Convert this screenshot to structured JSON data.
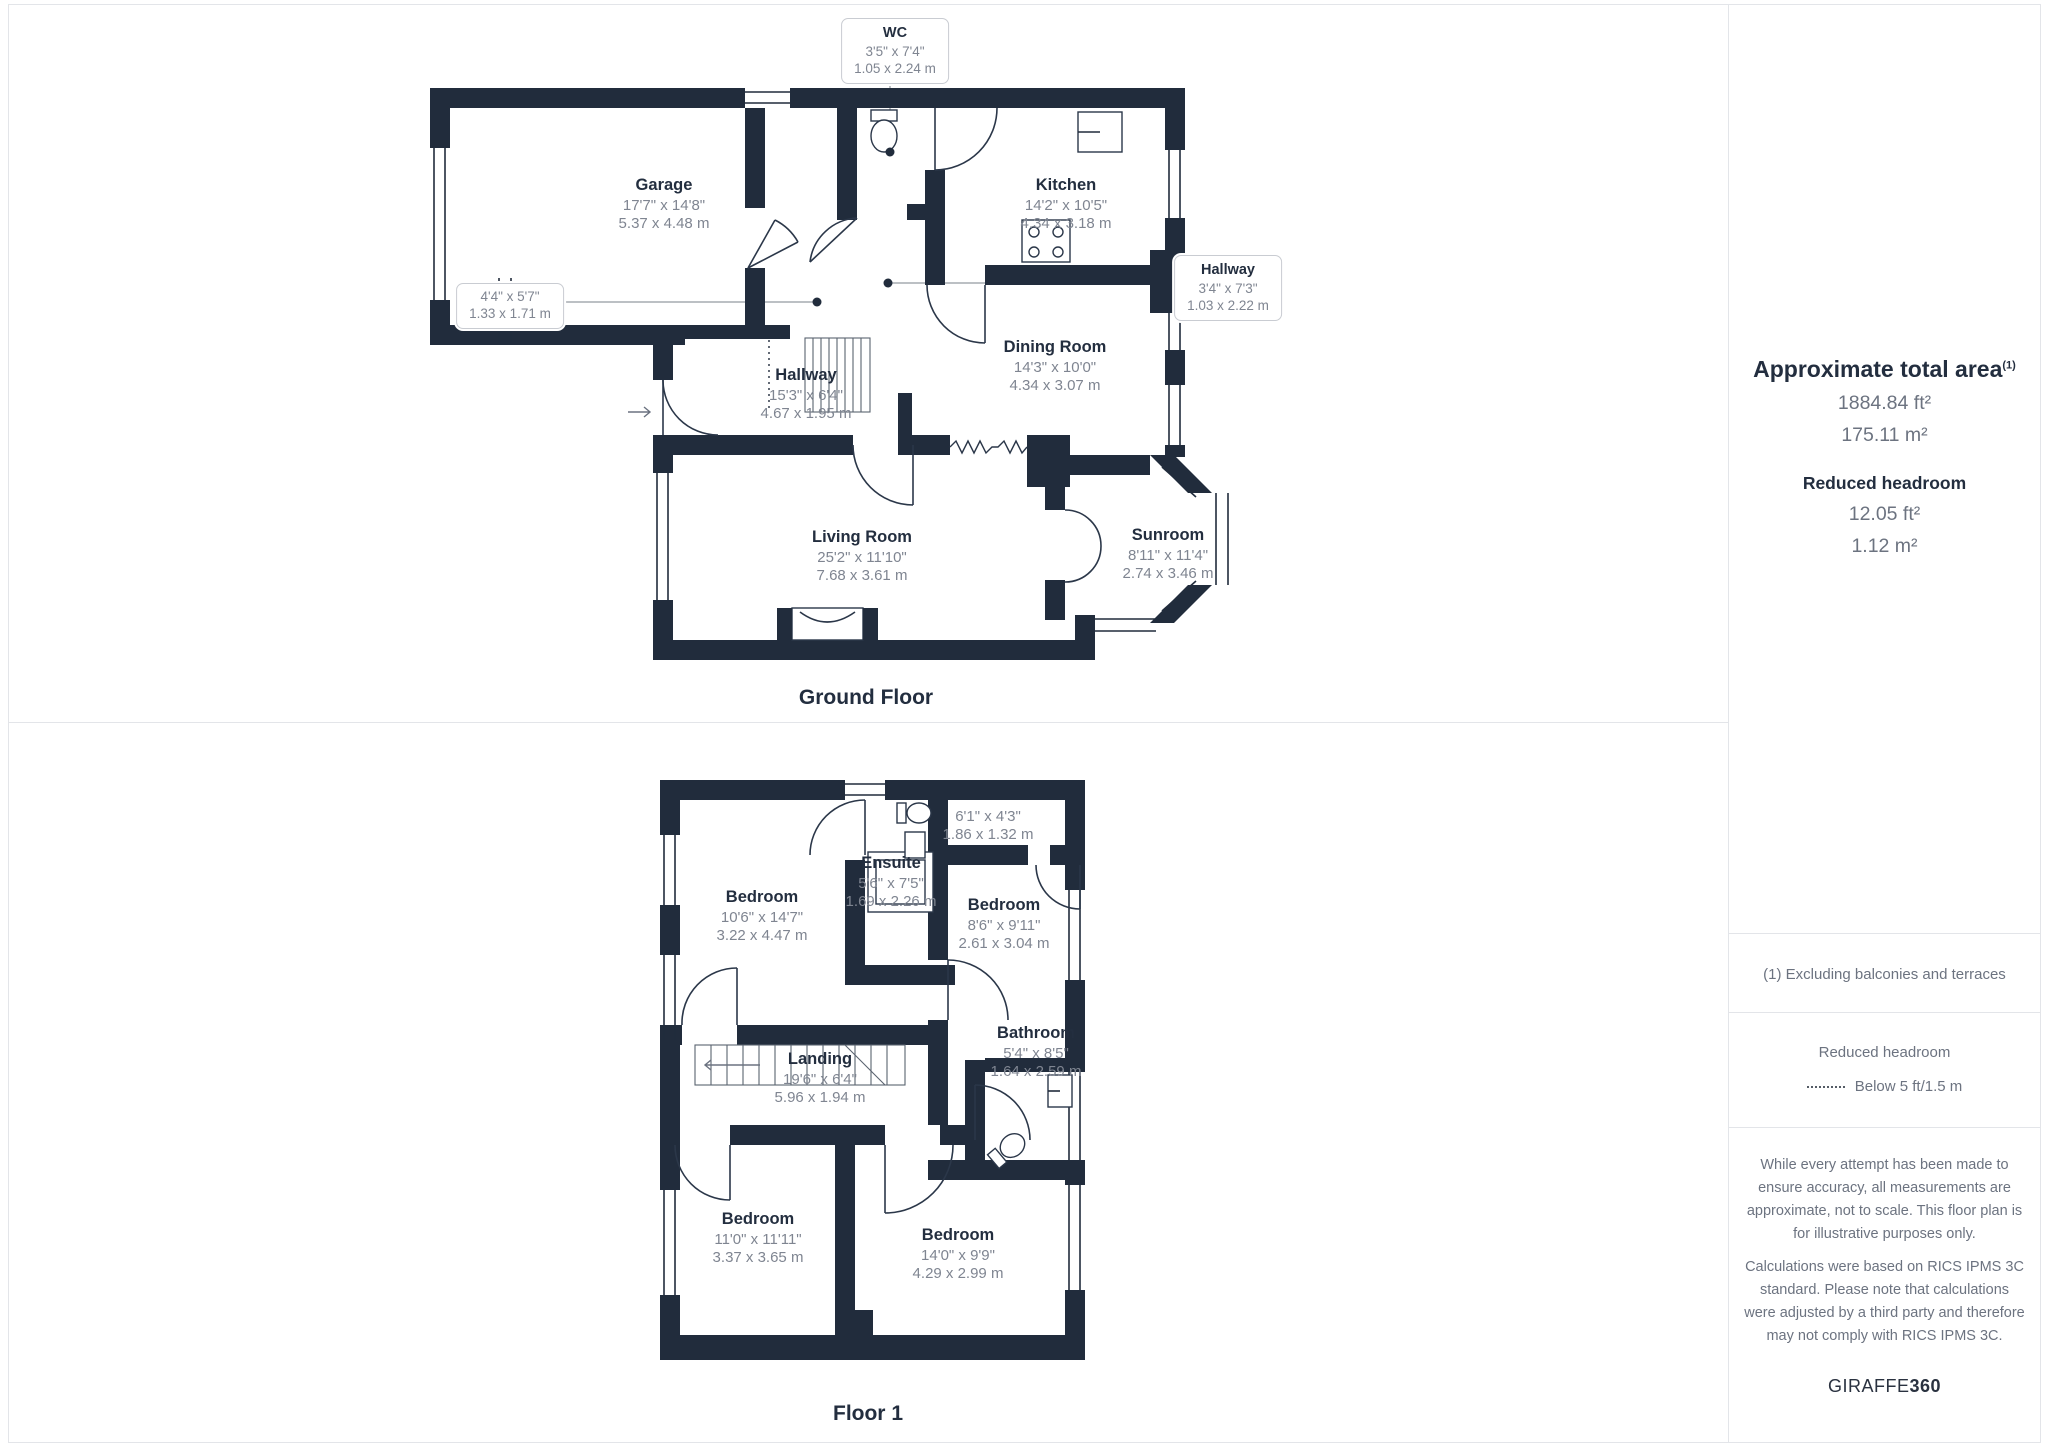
{
  "ground": {
    "title": "Ground Floor",
    "rooms": {
      "garage": {
        "name": "Garage",
        "imp": "17'7\" x 14'8\"",
        "met": "5.37 x 4.48 m"
      },
      "kitchen": {
        "name": "Kitchen",
        "imp": "14'2\" x 10'5\"",
        "met": "4.34 x 3.18 m"
      },
      "dining": {
        "name": "Dining Room",
        "imp": "14'3\" x 10'0\"",
        "met": "4.34 x 3.07 m"
      },
      "hallway": {
        "name": "Hallway",
        "imp": "15'3\" x 6'4\"",
        "met": "4.67 x 1.95 m"
      },
      "living": {
        "name": "Living Room",
        "imp": "25'2\" x 11'10\"",
        "met": "7.68 x 3.61 m"
      },
      "sunroom": {
        "name": "Sunroom",
        "imp": "8'11\" x 11'4\"",
        "met": "2.74 x 3.46 m"
      }
    },
    "callouts": {
      "wc": {
        "name": "WC",
        "imp": "3'5\" x 7'4\"",
        "met": "1.05 x 2.24 m"
      },
      "closet": {
        "imp": "4'4\" x 5'7\"",
        "met": "1.33 x 1.71 m"
      },
      "hallway2": {
        "name": "Hallway",
        "imp": "3'4\" x 7'3\"",
        "met": "1.03 x 2.22 m"
      }
    }
  },
  "floor1": {
    "title": "Floor 1",
    "rooms": {
      "bedroom_tl": {
        "name": "Bedroom",
        "imp": "10'6\" x 14'7\"",
        "met": "3.22 x 4.47 m"
      },
      "ensuite": {
        "name": "Ensuite",
        "imp": "5'6\" x 7'5\"",
        "met": "1.69 x 2.26 m"
      },
      "closet": {
        "imp": "6'1\" x 4'3\"",
        "met": "1.86 x 1.32 m"
      },
      "bedroom_r": {
        "name": "Bedroom",
        "imp": "8'6\" x 9'11\"",
        "met": "2.61 x 3.04 m"
      },
      "landing": {
        "name": "Landing",
        "imp": "19'6\" x 6'4\"",
        "met": "5.96 x 1.94 m"
      },
      "bathroom": {
        "name": "Bathroom",
        "imp": "5'4\" x 8'5\"",
        "met": "1.64 x 2.59 m"
      },
      "bedroom_bl": {
        "name": "Bedroom",
        "imp": "11'0\" x 11'11\"",
        "met": "3.37 x 3.65 m"
      },
      "bedroom_br": {
        "name": "Bedroom",
        "imp": "14'0\" x 9'9\"",
        "met": "4.29 x 2.99 m"
      }
    }
  },
  "sidebar": {
    "area_title": "Approximate total area",
    "area_note_ref": "(1)",
    "area_ft": "1884.84 ft²",
    "area_m": "175.11 m²",
    "reduced_title": "Reduced headroom",
    "reduced_ft": "12.05 ft²",
    "reduced_m": "1.12 m²",
    "note": "(1) Excluding balconies and terraces",
    "legend_title": "Reduced headroom",
    "legend_label": "Below 5 ft/1.5 m",
    "disclaimer1": "While every attempt has been made to ensure accuracy, all measurements are approximate, not to scale. This floor plan is for illustrative purposes only.",
    "disclaimer2": "Calculations were based on RICS IPMS 3C standard. Please note that calculations were adjusted by a third party and therefore may not comply with RICS IPMS 3C.",
    "brand_1": "GIRAFFE",
    "brand_2": "360"
  },
  "colors": {
    "wall": "#212c3c",
    "label_text": "#232e3f",
    "dim_text": "#7f8591",
    "divider": "#e3e5e9"
  }
}
